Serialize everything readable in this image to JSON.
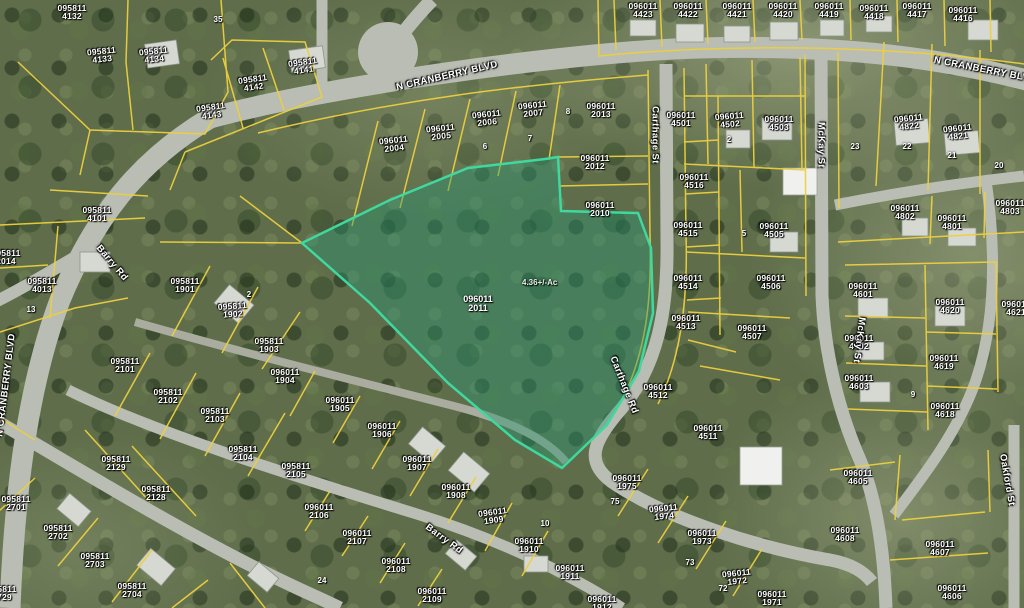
{
  "map": {
    "colors": {
      "parcel_line": "#ecd03e",
      "road": "#b9bdb3",
      "road_minor": "#a9ac9e",
      "highlight_stroke": "#3fd89f",
      "highlight_fill": "rgba(40,150,115,0.42)",
      "label_text": "#ffffff"
    },
    "highlight": {
      "id_line1": "096011",
      "id_line2": "2011",
      "area_label": "4.36+/-Ac",
      "polygon": "302,243 390,200 468,168 545,159 558,157 561,211 638,213 651,248 653,313 639,371 607,425 562,468 515,440 448,383 370,303"
    },
    "street_labels": [
      {
        "text": "N CRANBERRY BLVD",
        "x": 447,
        "y": 76,
        "rot": -13
      },
      {
        "text": "N CRANBERRY BLVD",
        "x": 985,
        "y": 70,
        "rot": 11
      },
      {
        "text": "N CRANBERRY BLVD",
        "x": 6,
        "y": 385,
        "rot": -83
      },
      {
        "text": "Carthage St",
        "x": 655,
        "y": 135,
        "rot": 90
      },
      {
        "text": "Carthage Rd",
        "x": 624,
        "y": 385,
        "rot": 68
      },
      {
        "text": "McKay St",
        "x": 821,
        "y": 145,
        "rot": 90
      },
      {
        "text": "McKay St",
        "x": 859,
        "y": 340,
        "rot": 97
      },
      {
        "text": "Barry Rd",
        "x": 112,
        "y": 263,
        "rot": 50
      },
      {
        "text": "Barry Rd",
        "x": 444,
        "y": 539,
        "rot": 36
      },
      {
        "text": "Oakford St",
        "x": 1007,
        "y": 480,
        "rot": 80
      }
    ],
    "parcel_labels": [
      {
        "l1": "095811",
        "l2": "4132",
        "x": 72,
        "y": 4,
        "rot": 0
      },
      {
        "l1": "095811",
        "l2": "4133",
        "x": 101,
        "y": 47,
        "rot": -6
      },
      {
        "l1": "095811",
        "l2": "4134",
        "x": 153,
        "y": 47,
        "rot": -6
      },
      {
        "l1": "095811",
        "l2": "4141",
        "x": 302,
        "y": 58,
        "rot": -8
      },
      {
        "l1": "095811",
        "l2": "4142",
        "x": 252,
        "y": 75,
        "rot": -8
      },
      {
        "l1": "095811",
        "l2": "4143",
        "x": 210,
        "y": 103,
        "rot": -8
      },
      {
        "l1": "095811",
        "l2": "4101",
        "x": 97,
        "y": 206,
        "rot": 0
      },
      {
        "l1": "095811",
        "l2": "2014",
        "x": 6,
        "y": 249,
        "rot": 0
      },
      {
        "l1": "095811",
        "l2": "4013",
        "x": 42,
        "y": 277,
        "rot": 0
      },
      {
        "l1": "095811",
        "l2": "1901",
        "x": 185,
        "y": 277,
        "rot": 0
      },
      {
        "l1": "095811",
        "l2": "1902",
        "x": 232,
        "y": 302,
        "rot": -4
      },
      {
        "l1": "095811",
        "l2": "1903",
        "x": 269,
        "y": 337,
        "rot": 0
      },
      {
        "l1": "095811",
        "l2": "2101",
        "x": 125,
        "y": 357,
        "rot": 0
      },
      {
        "l1": "095811",
        "l2": "2102",
        "x": 168,
        "y": 388,
        "rot": 0
      },
      {
        "l1": "095811",
        "l2": "2103",
        "x": 215,
        "y": 407,
        "rot": 0
      },
      {
        "l1": "095811",
        "l2": "2104",
        "x": 243,
        "y": 445,
        "rot": 0
      },
      {
        "l1": "095811",
        "l2": "2105",
        "x": 296,
        "y": 462,
        "rot": 0
      },
      {
        "l1": "095811",
        "l2": "2129",
        "x": 116,
        "y": 455,
        "rot": 0
      },
      {
        "l1": "095811",
        "l2": "2128",
        "x": 156,
        "y": 485,
        "rot": 0
      },
      {
        "l1": "095811",
        "l2": "2701",
        "x": 16,
        "y": 495,
        "rot": 0
      },
      {
        "l1": "095811",
        "l2": "2702",
        "x": 58,
        "y": 524,
        "rot": 0
      },
      {
        "l1": "095811",
        "l2": "2703",
        "x": 95,
        "y": 552,
        "rot": 0
      },
      {
        "l1": "095811",
        "l2": "2704",
        "x": 132,
        "y": 582,
        "rot": 0
      },
      {
        "l1": "095811",
        "l2": "2729",
        "x": 2,
        "y": 585,
        "rot": 0
      },
      {
        "l1": "096011",
        "l2": "2004",
        "x": 393,
        "y": 136,
        "rot": -6
      },
      {
        "l1": "096011",
        "l2": "2005",
        "x": 440,
        "y": 124,
        "rot": -6
      },
      {
        "l1": "096011",
        "l2": "2006",
        "x": 486,
        "y": 110,
        "rot": -6
      },
      {
        "l1": "096011",
        "l2": "2007",
        "x": 532,
        "y": 101,
        "rot": -6
      },
      {
        "l1": "096011",
        "l2": "2013",
        "x": 601,
        "y": 102,
        "rot": 0
      },
      {
        "l1": "096011",
        "l2": "2012",
        "x": 595,
        "y": 154,
        "rot": 0
      },
      {
        "l1": "096011",
        "l2": "2010",
        "x": 600,
        "y": 201,
        "rot": 0
      },
      {
        "l1": "096011",
        "l2": "1904",
        "x": 285,
        "y": 368,
        "rot": 0
      },
      {
        "l1": "096011",
        "l2": "1905",
        "x": 340,
        "y": 396,
        "rot": 0
      },
      {
        "l1": "096011",
        "l2": "1906",
        "x": 382,
        "y": 422,
        "rot": 0
      },
      {
        "l1": "096011",
        "l2": "1907",
        "x": 417,
        "y": 455,
        "rot": 0
      },
      {
        "l1": "096011",
        "l2": "1908",
        "x": 456,
        "y": 483,
        "rot": 0
      },
      {
        "l1": "096011",
        "l2": "1909",
        "x": 492,
        "y": 508,
        "rot": -8
      },
      {
        "l1": "096011",
        "l2": "1910",
        "x": 529,
        "y": 537,
        "rot": 0
      },
      {
        "l1": "096011",
        "l2": "1911",
        "x": 570,
        "y": 564,
        "rot": 0
      },
      {
        "l1": "096011",
        "l2": "1912",
        "x": 602,
        "y": 595,
        "rot": 0
      },
      {
        "l1": "096011",
        "l2": "2106",
        "x": 319,
        "y": 503,
        "rot": 0
      },
      {
        "l1": "096011",
        "l2": "2107",
        "x": 357,
        "y": 529,
        "rot": 0
      },
      {
        "l1": "096011",
        "l2": "2108",
        "x": 396,
        "y": 557,
        "rot": 0
      },
      {
        "l1": "096011",
        "l2": "2109",
        "x": 432,
        "y": 587,
        "rot": 0
      },
      {
        "l1": "096011",
        "l2": "1975",
        "x": 627,
        "y": 474,
        "rot": 0
      },
      {
        "l1": "096011",
        "l2": "1974",
        "x": 663,
        "y": 504,
        "rot": -6
      },
      {
        "l1": "096011",
        "l2": "1973",
        "x": 702,
        "y": 529,
        "rot": 0
      },
      {
        "l1": "096011",
        "l2": "1972",
        "x": 736,
        "y": 569,
        "rot": -6
      },
      {
        "l1": "096011",
        "l2": "1971",
        "x": 772,
        "y": 590,
        "rot": 0
      },
      {
        "l1": "096011",
        "l2": "4423",
        "x": 643,
        "y": 2,
        "rot": 0
      },
      {
        "l1": "096011",
        "l2": "4422",
        "x": 688,
        "y": 2,
        "rot": 0
      },
      {
        "l1": "096011",
        "l2": "4421",
        "x": 737,
        "y": 2,
        "rot": 0
      },
      {
        "l1": "096011",
        "l2": "4420",
        "x": 783,
        "y": 2,
        "rot": 0
      },
      {
        "l1": "096011",
        "l2": "4419",
        "x": 829,
        "y": 2,
        "rot": 0
      },
      {
        "l1": "096011",
        "l2": "4418",
        "x": 874,
        "y": 4,
        "rot": 0
      },
      {
        "l1": "096011",
        "l2": "4417",
        "x": 917,
        "y": 2,
        "rot": 0
      },
      {
        "l1": "096011",
        "l2": "4416",
        "x": 963,
        "y": 6,
        "rot": 0
      },
      {
        "l1": "096011",
        "l2": "4501",
        "x": 681,
        "y": 111,
        "rot": 0
      },
      {
        "l1": "096011",
        "l2": "4502",
        "x": 729,
        "y": 112,
        "rot": -5
      },
      {
        "l1": "096011",
        "l2": "4503",
        "x": 779,
        "y": 115,
        "rot": 0
      },
      {
        "l1": "096011",
        "l2": "4516",
        "x": 694,
        "y": 173,
        "rot": 0
      },
      {
        "l1": "096011",
        "l2": "4515",
        "x": 688,
        "y": 221,
        "rot": 0
      },
      {
        "l1": "096011",
        "l2": "4514",
        "x": 688,
        "y": 274,
        "rot": 0
      },
      {
        "l1": "096011",
        "l2": "4513",
        "x": 686,
        "y": 314,
        "rot": 0
      },
      {
        "l1": "096011",
        "l2": "4512",
        "x": 658,
        "y": 383,
        "rot": 0
      },
      {
        "l1": "096011",
        "l2": "4511",
        "x": 708,
        "y": 424,
        "rot": 0
      },
      {
        "l1": "096011",
        "l2": "4505",
        "x": 774,
        "y": 222,
        "rot": 0
      },
      {
        "l1": "096011",
        "l2": "4506",
        "x": 771,
        "y": 274,
        "rot": 0
      },
      {
        "l1": "096011",
        "l2": "4507",
        "x": 752,
        "y": 324,
        "rot": 0
      },
      {
        "l1": "096011",
        "l2": "4822",
        "x": 908,
        "y": 114,
        "rot": -6
      },
      {
        "l1": "096011",
        "l2": "4821",
        "x": 957,
        "y": 124,
        "rot": -6
      },
      {
        "l1": "096011",
        "l2": "4802",
        "x": 905,
        "y": 204,
        "rot": 0
      },
      {
        "l1": "096011",
        "l2": "4801",
        "x": 952,
        "y": 214,
        "rot": 0
      },
      {
        "l1": "096011",
        "l2": "4803",
        "x": 1010,
        "y": 199,
        "rot": 0
      },
      {
        "l1": "096011",
        "l2": "4601",
        "x": 863,
        "y": 282,
        "rot": 0
      },
      {
        "l1": "096011",
        "l2": "4620",
        "x": 950,
        "y": 298,
        "rot": 0
      },
      {
        "l1": "096011",
        "l2": "4602",
        "x": 859,
        "y": 334,
        "rot": 0
      },
      {
        "l1": "096011",
        "l2": "4619",
        "x": 944,
        "y": 354,
        "rot": 0
      },
      {
        "l1": "096011",
        "l2": "4603",
        "x": 859,
        "y": 374,
        "rot": 0
      },
      {
        "l1": "096011",
        "l2": "4618",
        "x": 945,
        "y": 402,
        "rot": 0
      },
      {
        "l1": "096011",
        "l2": "4621",
        "x": 1016,
        "y": 300,
        "rot": 0
      },
      {
        "l1": "096011",
        "l2": "4605",
        "x": 858,
        "y": 469,
        "rot": 0
      },
      {
        "l1": "096011",
        "l2": "4608",
        "x": 845,
        "y": 526,
        "rot": 0
      },
      {
        "l1": "096011",
        "l2": "4607",
        "x": 940,
        "y": 540,
        "rot": 0
      },
      {
        "l1": "096011",
        "l2": "4606",
        "x": 952,
        "y": 584,
        "rot": 0
      }
    ],
    "lot_numbers": [
      {
        "text": "35",
        "x": 218,
        "y": 15
      },
      {
        "text": "13",
        "x": 31,
        "y": 305
      },
      {
        "text": "2",
        "x": 249,
        "y": 290
      },
      {
        "text": "2",
        "x": 729,
        "y": 135
      },
      {
        "text": "5",
        "x": 744,
        "y": 229
      },
      {
        "text": "8",
        "x": 568,
        "y": 107
      },
      {
        "text": "7",
        "x": 530,
        "y": 134
      },
      {
        "text": "6",
        "x": 485,
        "y": 142
      },
      {
        "text": "23",
        "x": 855,
        "y": 142
      },
      {
        "text": "22",
        "x": 907,
        "y": 142
      },
      {
        "text": "21",
        "x": 952,
        "y": 151
      },
      {
        "text": "20",
        "x": 999,
        "y": 161
      },
      {
        "text": "9",
        "x": 913,
        "y": 390
      },
      {
        "text": "24",
        "x": 322,
        "y": 576
      },
      {
        "text": "10",
        "x": 545,
        "y": 519
      },
      {
        "text": "75",
        "x": 615,
        "y": 497
      },
      {
        "text": "73",
        "x": 690,
        "y": 558
      },
      {
        "text": "72",
        "x": 723,
        "y": 584
      }
    ]
  }
}
